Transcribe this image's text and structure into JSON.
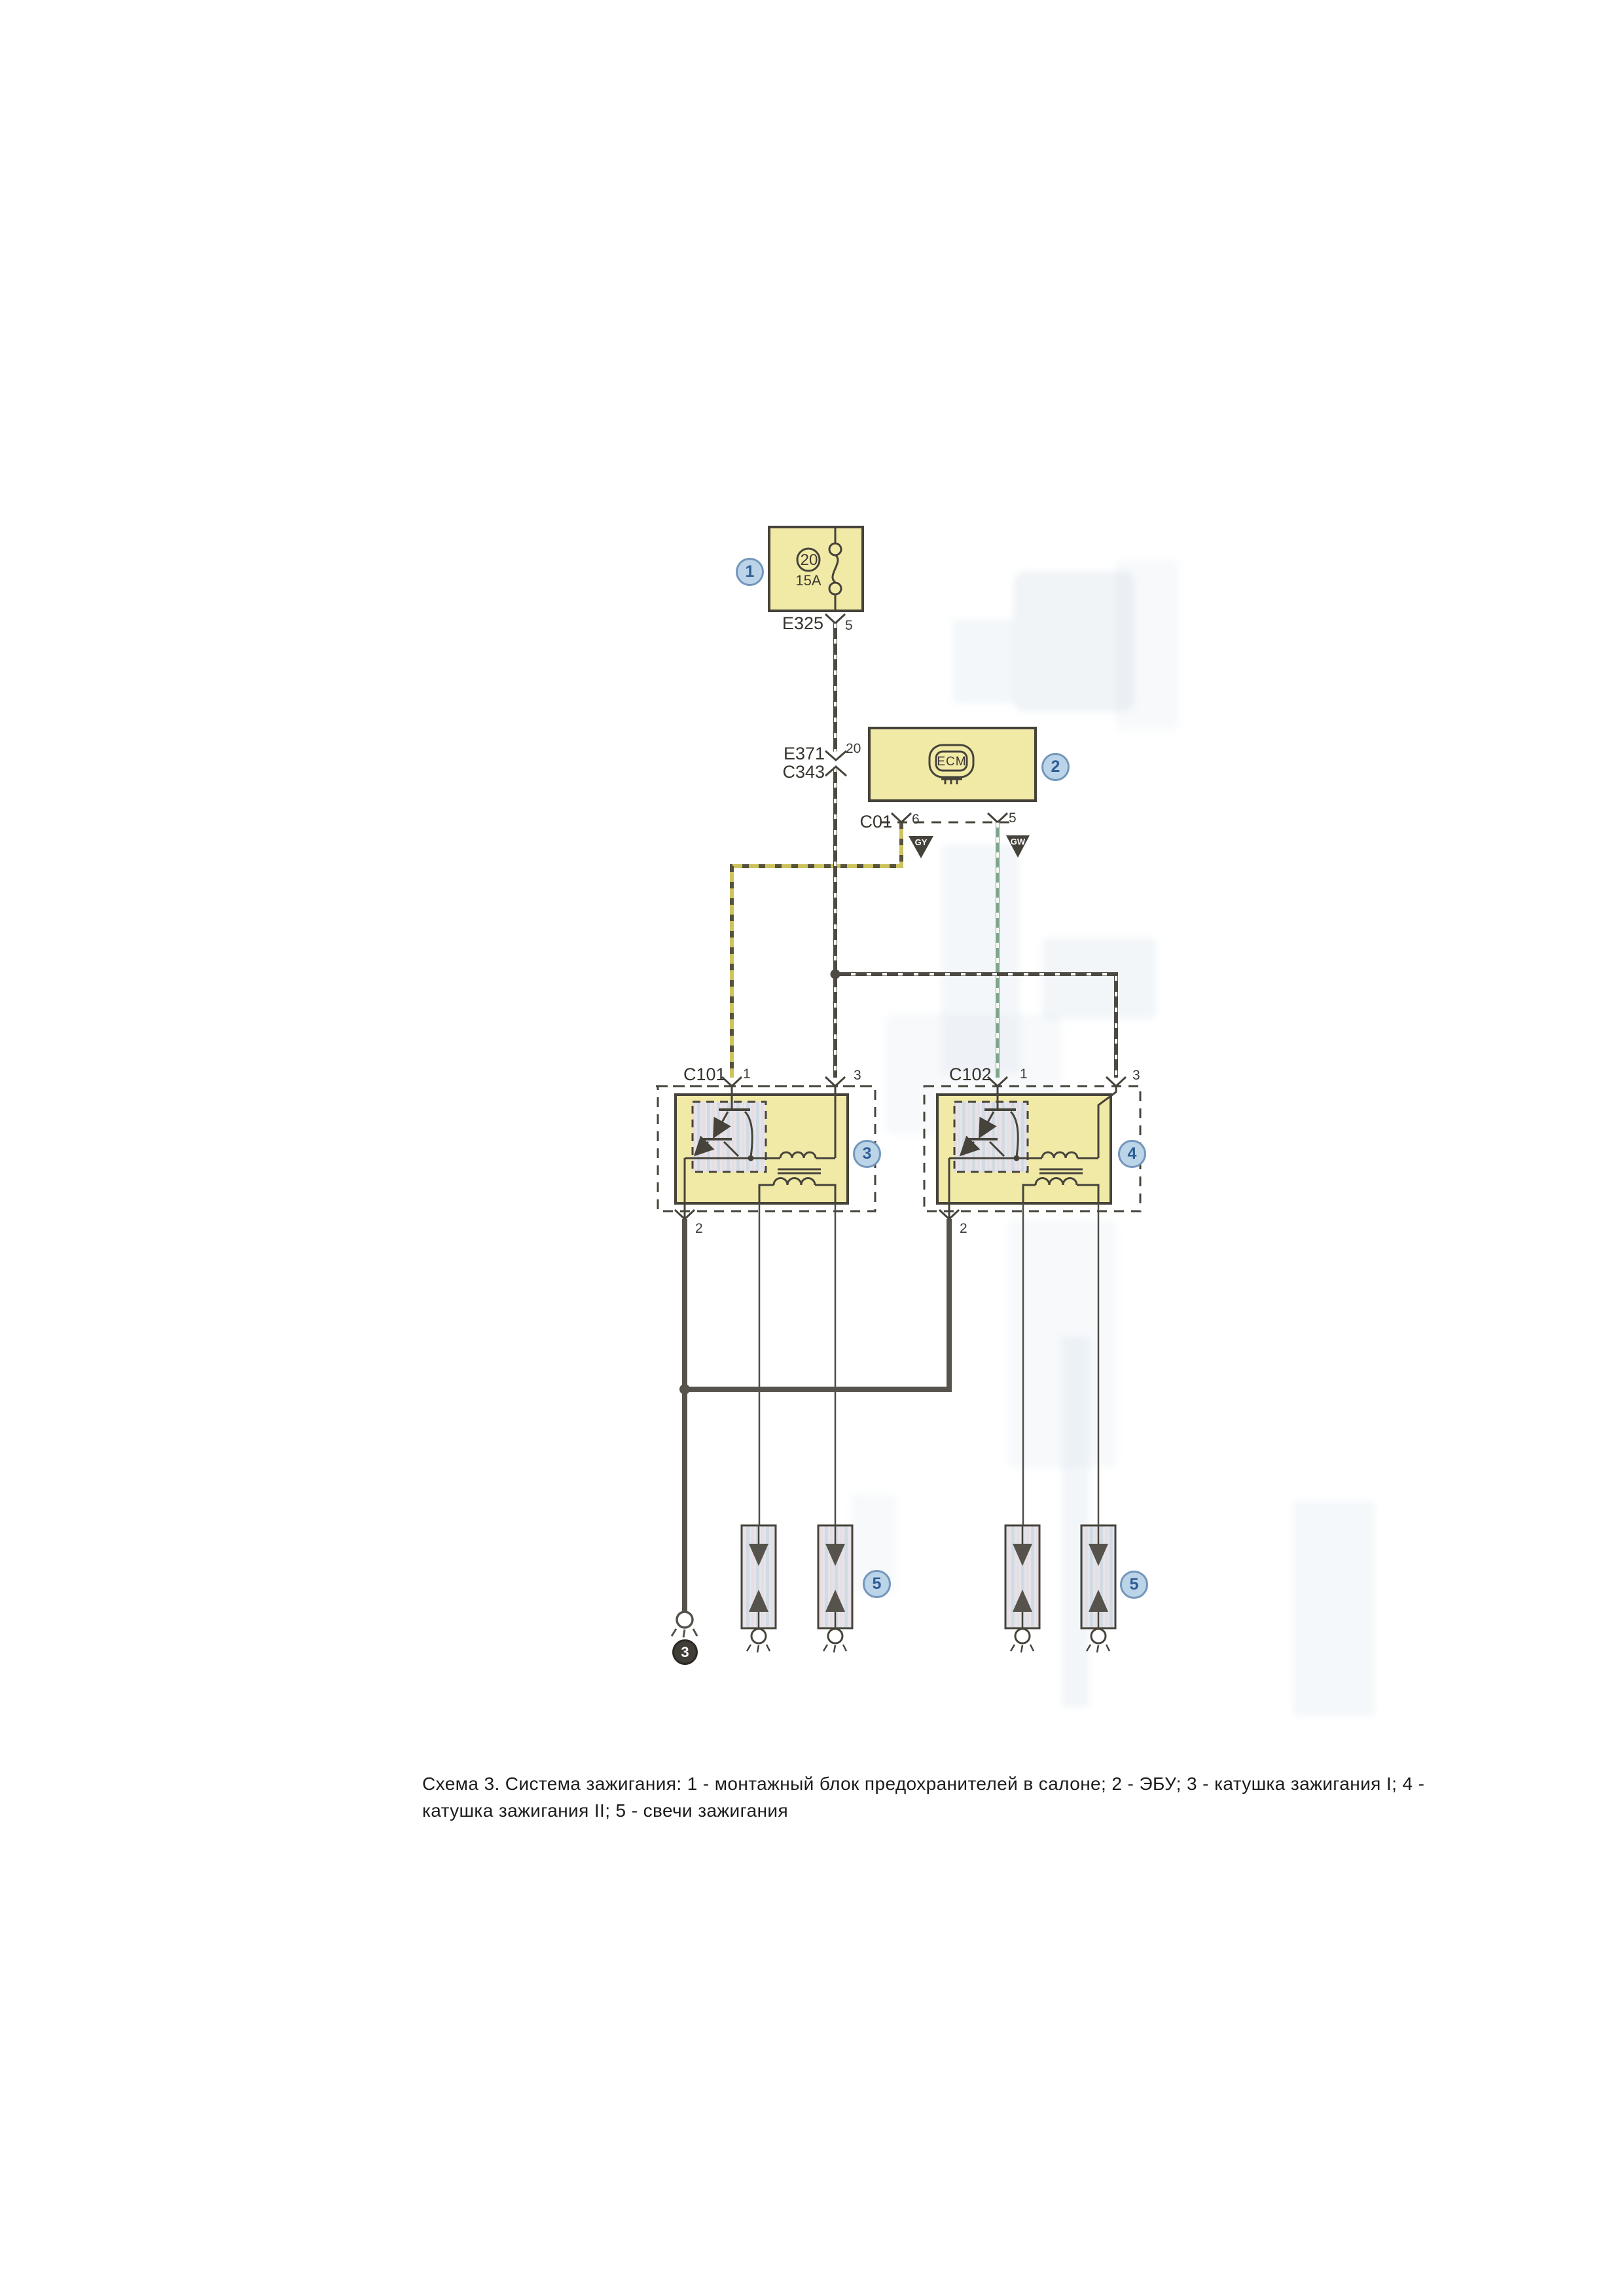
{
  "caption": {
    "line1": "Схема 3. Система зажигания: 1 - монтажный блок предохранителей в салоне; 2 - ЭБУ; 3 - катушка зажигания I; 4 -",
    "line2": "катушка зажигания  II;  5 - свечи зажигания"
  },
  "fuse_block": {
    "connector": "E325",
    "pin": "5",
    "fuse_no": "20",
    "rating": "15A"
  },
  "inline_connector": {
    "label_top": "E371",
    "label_bottom": "C343",
    "pin": "20"
  },
  "ecm": {
    "logo": "ECM",
    "connector": "C01",
    "pin_left": "6",
    "pin_right": "5"
  },
  "wire_codes": {
    "left": "GY",
    "right": "GW"
  },
  "coil1": {
    "connector": "C101",
    "pin_supply": "1",
    "pin_b": "3",
    "pin_ground": "2"
  },
  "coil2": {
    "connector": "C102",
    "pin_supply": "1",
    "pin_b": "3",
    "pin_ground": "2"
  },
  "ground_point": {
    "id": "3"
  },
  "callouts": {
    "c1": "1",
    "c2": "2",
    "c3": "3",
    "c4": "4",
    "c5_left": "5",
    "c5_right": "5"
  },
  "colors": {
    "box_fill": "#f1e9a6",
    "box_border": "#45433a",
    "wire_dark": "#4c4a42",
    "wire_yellow": "#cdc45e",
    "wire_green": "#7fa58c",
    "ground_wire": "#55534b",
    "callout_fill": "#bcd4e8",
    "callout_border": "#7396bc",
    "callout_text": "#2e5d94",
    "ghost": "#c9d6e4"
  }
}
